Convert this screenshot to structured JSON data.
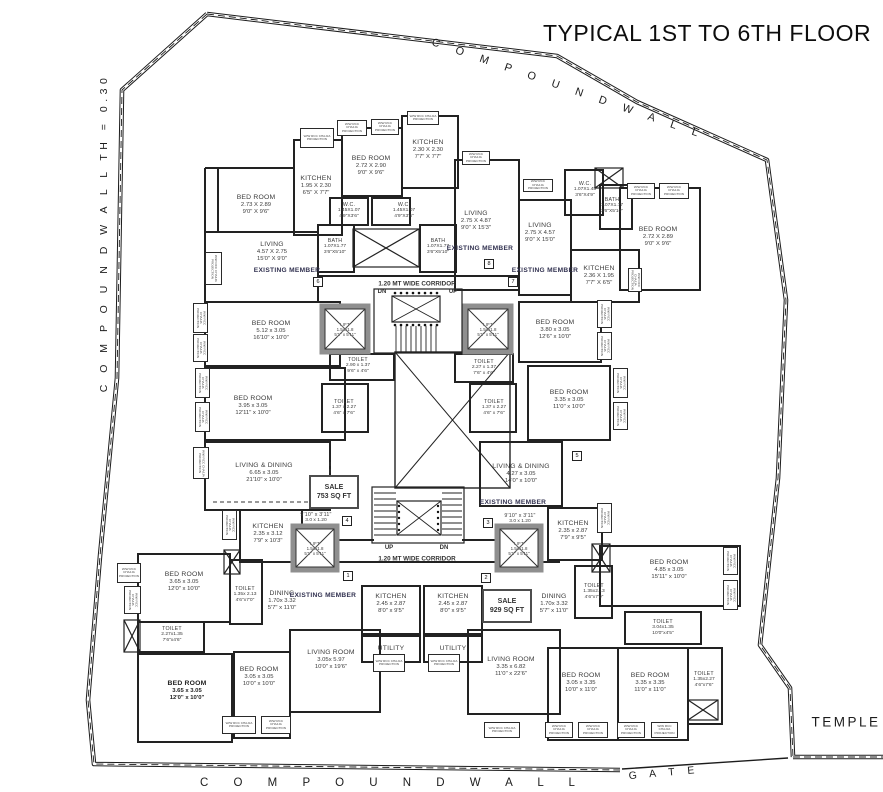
{
  "title": "TYPICAL 1ST TO 6TH FLOOR",
  "boundary": {
    "top_label": "C O M P O U N D   W A L L",
    "left_label": "C O M P O U N D   W A L L   TH = 0.30",
    "bottom_label": "C O M P O U N D   W A L L",
    "gate_label": "G A T E",
    "temple_label": "TEMPLE"
  },
  "corridor": {
    "label": "1.20 MT WIDE CORRIDOR",
    "up": "UP",
    "dn": "DN"
  },
  "colors": {
    "wall": "#222222",
    "lift_border": "#8f8f8f",
    "text": "#3c3c3c",
    "existing_member": "#30304f"
  },
  "chajja": {
    "text": "W/W RCC CHAJJA PROJECTION",
    "boxes": [
      [
        300,
        128,
        34,
        20,
        0
      ],
      [
        337,
        120,
        30,
        16,
        0
      ],
      [
        371,
        119,
        28,
        16,
        0
      ],
      [
        407,
        111,
        32,
        14,
        0
      ],
      [
        462,
        151,
        28,
        14,
        0
      ],
      [
        523,
        179,
        30,
        13,
        0
      ],
      [
        627,
        183,
        28,
        16,
        0
      ],
      [
        659,
        183,
        30,
        16,
        0
      ],
      [
        205,
        252,
        17,
        33,
        1
      ],
      [
        193,
        303,
        15,
        30,
        1
      ],
      [
        193,
        334,
        15,
        28,
        1
      ],
      [
        195,
        368,
        15,
        30,
        1
      ],
      [
        195,
        402,
        15,
        30,
        1
      ],
      [
        193,
        447,
        16,
        32,
        1
      ],
      [
        222,
        510,
        15,
        30,
        1
      ],
      [
        117,
        563,
        24,
        20,
        0
      ],
      [
        124,
        586,
        17,
        28,
        1
      ],
      [
        628,
        268,
        14,
        24,
        1
      ],
      [
        597,
        300,
        15,
        28,
        1
      ],
      [
        597,
        332,
        15,
        28,
        1
      ],
      [
        613,
        368,
        15,
        30,
        1
      ],
      [
        613,
        402,
        15,
        28,
        1
      ],
      [
        597,
        503,
        15,
        30,
        1
      ],
      [
        723,
        547,
        15,
        28,
        1
      ],
      [
        723,
        580,
        15,
        30,
        1
      ],
      [
        222,
        716,
        34,
        18,
        0
      ],
      [
        261,
        716,
        30,
        18,
        0
      ],
      [
        373,
        654,
        32,
        18,
        0
      ],
      [
        428,
        654,
        32,
        18,
        0
      ],
      [
        484,
        722,
        36,
        16,
        0
      ],
      [
        545,
        722,
        28,
        16,
        0
      ],
      [
        578,
        722,
        30,
        16,
        0
      ],
      [
        617,
        722,
        28,
        16,
        0
      ],
      [
        651,
        722,
        27,
        16,
        0
      ]
    ]
  },
  "sale_tags": [
    {
      "line1": "SALE",
      "line2": "753 SQ FT",
      "x": 334,
      "y": 492
    },
    {
      "line1": "SALE",
      "line2": "929 SQ FT",
      "x": 507,
      "y": 606
    }
  ],
  "flat_markers": [
    {
      "t": "1",
      "x": 348,
      "y": 576
    },
    {
      "t": "2",
      "x": 486,
      "y": 578
    },
    {
      "t": "3",
      "x": 488,
      "y": 523
    },
    {
      "t": "4",
      "x": 347,
      "y": 521
    },
    {
      "t": "5",
      "x": 577,
      "y": 456
    },
    {
      "t": "6",
      "x": 318,
      "y": 282
    },
    {
      "t": "7",
      "x": 513,
      "y": 282
    },
    {
      "t": "8",
      "x": 489,
      "y": 264
    }
  ],
  "rooms": [
    {
      "n": "BED ROOM",
      "m": "2.73 X 2.89",
      "f": "9'0\" X 9'6\"",
      "x": 256,
      "y": 205
    },
    {
      "n": "KITCHEN",
      "m": "1.95 X 2.30",
      "f": "6'5\" X 7'7\"",
      "x": 316,
      "y": 186
    },
    {
      "n": "BED ROOM",
      "m": "2.72 X 2.90",
      "f": "9'0\" X 9'6\"",
      "x": 371,
      "y": 166
    },
    {
      "n": "KITCHEN",
      "m": "2.30 X 2.30",
      "f": "7'7\" X 7'7\"",
      "x": 428,
      "y": 150
    },
    {
      "n": "W.C.",
      "m": "1.45X1.07",
      "f": "4'9\"X3'6\"",
      "x": 349,
      "y": 211,
      "cls": "small"
    },
    {
      "n": "W.C.",
      "m": "1.45X1.07",
      "f": "4'9\"X3'6\"",
      "x": 404,
      "y": 211,
      "cls": "small"
    },
    {
      "n": "BATH",
      "m": "1.07X1.77",
      "f": "3'6\"X5'10\"",
      "x": 335,
      "y": 247,
      "cls": "small"
    },
    {
      "n": "BATH",
      "m": "1.07X1.77",
      "f": "3'6\"X5'10\"",
      "x": 438,
      "y": 247,
      "cls": "small"
    },
    {
      "n": "LIVING",
      "m": "4.57 X 2.75",
      "f": "15'0\" X 9'0\"",
      "x": 272,
      "y": 252
    },
    {
      "n": "EXISTING MEMBER",
      "x": 287,
      "y": 271,
      "cls": "em"
    },
    {
      "n": "LIVING",
      "m": "2.75 X 4.87",
      "f": "9'0\" X 15'3\"",
      "x": 476,
      "y": 221
    },
    {
      "n": "EXISTING MEMBER",
      "x": 480,
      "y": 249,
      "cls": "em"
    },
    {
      "n": "LIVING",
      "m": "2.75 X 4.57",
      "f": "9'0\" X 15'0\"",
      "x": 540,
      "y": 233
    },
    {
      "n": "EXISTING MEMBER",
      "x": 545,
      "y": 271,
      "cls": "em"
    },
    {
      "n": "W.C.",
      "m": "1.07X1.45",
      "f": "3'6\"X4'9\"",
      "x": 585,
      "y": 190,
      "cls": "small"
    },
    {
      "n": "BATH",
      "m": "1.07X1.77",
      "f": "3'6\"X5'10\"",
      "x": 612,
      "y": 206,
      "cls": "small"
    },
    {
      "n": "BED ROOM",
      "m": "2.72 X 2.89",
      "f": "9'0\" X 9'6\"",
      "x": 658,
      "y": 237
    },
    {
      "n": "KITCHEN",
      "m": "2.36 X 1.95",
      "f": "7'7\" X 6'5\"",
      "x": 599,
      "y": 276
    },
    {
      "n": "BED ROOM",
      "m": "5.12 x 3.05",
      "f": "16'10\" x 10'0\"",
      "x": 271,
      "y": 331
    },
    {
      "n": "BED ROOM",
      "m": "3.95 x 3.05",
      "f": "12'11\" x 10'0\"",
      "x": 253,
      "y": 406
    },
    {
      "n": "TOILET",
      "m": "2.90 x 1.37",
      "f": "9'6\" x 4'6\"",
      "x": 358,
      "y": 366,
      "cls": "small"
    },
    {
      "n": "TOILET",
      "m": "2.27 x 1.37",
      "f": "7'6\" x 4'6\"",
      "x": 484,
      "y": 368,
      "cls": "small"
    },
    {
      "n": "TOILET",
      "m": "1.37 x 2.27",
      "f": "4'6\" x 7'6\"",
      "x": 344,
      "y": 408,
      "cls": "small"
    },
    {
      "n": "TOILET",
      "m": "1.37 x 2.27",
      "f": "4'6\" x 7'6\"",
      "x": 494,
      "y": 408,
      "cls": "small"
    },
    {
      "n": "BED ROOM",
      "m": "3.80 x 3.05",
      "f": "12'6\" x 10'0\"",
      "x": 555,
      "y": 330
    },
    {
      "n": "BED ROOM",
      "m": "3.35 x 3.05",
      "f": "11'0\" x 10'0\"",
      "x": 569,
      "y": 400
    },
    {
      "n": "LIVING & DINING",
      "m": "6.65 x 3.05",
      "f": "21'10\" x 10'0\"",
      "x": 264,
      "y": 473
    },
    {
      "n": "LIVING & DINING",
      "m": "4.27 x 3.05",
      "f": "14'0\" x 10'0\"",
      "x": 521,
      "y": 474
    },
    {
      "n": "9'10\" x 3'11\"",
      "m": "3.0 x 1.20",
      "x": 316,
      "y": 518,
      "cls": "small"
    },
    {
      "n": "9'10\" x 3'11\"",
      "m": "3.0 x 1.20",
      "x": 520,
      "y": 519,
      "cls": "small"
    },
    {
      "n": "EXISTING MEMBER",
      "x": 513,
      "y": 503,
      "cls": "em"
    },
    {
      "n": "KITCHEN",
      "m": "2.35 x 3.12",
      "f": "7'9\" x 10'3\"",
      "x": 268,
      "y": 534
    },
    {
      "n": "KITCHEN",
      "m": "2.35 x 2.87",
      "f": "7'9\" x 9'5\"",
      "x": 573,
      "y": 531
    },
    {
      "n": "LIFT",
      "m": "1.54x1.8",
      "f": "5'1\" x 5'11\"",
      "x": 345,
      "y": 330,
      "cls": "lift"
    },
    {
      "n": "LIFT",
      "m": "1.54x1.8",
      "f": "5'1\" x 5'11\"",
      "x": 488,
      "y": 330,
      "cls": "lift"
    },
    {
      "n": "LIFT",
      "m": "1.54x1.8",
      "f": "5'1\" x 5'11\"",
      "x": 315,
      "y": 549,
      "cls": "lift"
    },
    {
      "n": "LIFT",
      "m": "1.54x1.8",
      "f": "5'1\" x 5'11\"",
      "x": 519,
      "y": 549,
      "cls": "lift"
    },
    {
      "n": "KITCHEN",
      "m": "2.45 x 2.87",
      "f": "8'0\" x 9'5\"",
      "x": 391,
      "y": 604
    },
    {
      "n": "KITCHEN",
      "m": "2.45 x 2.87",
      "f": "8'0\" x 9'5\"",
      "x": 453,
      "y": 604
    },
    {
      "n": "UTILITY",
      "x": 391,
      "y": 649
    },
    {
      "n": "UTILITY",
      "x": 453,
      "y": 649
    },
    {
      "n": "DINING",
      "m": "1.70x 3.32",
      "f": "5'7\" x 11'0\"",
      "x": 554,
      "y": 604
    },
    {
      "n": "DINING",
      "m": "1.70x 3.32",
      "f": "5'7\" x 11'0\"",
      "x": 282,
      "y": 601
    },
    {
      "n": "EXISTING MEMBER",
      "x": 323,
      "y": 596,
      "cls": "em"
    },
    {
      "n": "BED ROOM",
      "m": "3.65 x 3.05",
      "f": "12'0\" x 10'0\"",
      "x": 184,
      "y": 582
    },
    {
      "n": "TOILET",
      "m": "1.35x 2.13",
      "f": "4'6\"x7'0\"",
      "x": 245,
      "y": 595,
      "cls": "small"
    },
    {
      "n": "TOILET",
      "m": "2.27x1.35",
      "f": "7'6\"x4'6\"",
      "x": 172,
      "y": 635,
      "cls": "small"
    },
    {
      "n": "BED ROOM",
      "m": "3.65 x 3.05",
      "f": "12'0\" x 10'0\"",
      "x": 187,
      "y": 691,
      "cls": "bold"
    },
    {
      "n": "BED ROOM",
      "m": "3.05 x 3.05",
      "f": "10'0\" x 10'0\"",
      "x": 259,
      "y": 677
    },
    {
      "n": "LIVING ROOM",
      "m": "3.05x 5.97",
      "f": "10'0\" x 19'6\"",
      "x": 331,
      "y": 660
    },
    {
      "n": "LIVING ROOM",
      "m": "3.35 x 6.82",
      "f": "11'0\" x 22'6\"",
      "x": 511,
      "y": 667
    },
    {
      "n": "BED ROOM",
      "m": "4.85 x 3.05",
      "f": "15'11\" x 10'0\"",
      "x": 669,
      "y": 570
    },
    {
      "n": "TOILET",
      "m": "1.35x2.13",
      "f": "4'6\"x7'0\"",
      "x": 594,
      "y": 592,
      "cls": "small"
    },
    {
      "n": "TOILET",
      "m": "3.04x1.35",
      "f": "10'0\"x4'5\"",
      "x": 663,
      "y": 628,
      "cls": "small"
    },
    {
      "n": "BED ROOM",
      "m": "3.05 x 3.35",
      "f": "10'0\" x 11'0\"",
      "x": 581,
      "y": 683
    },
    {
      "n": "BED ROOM",
      "m": "3.35 x 3.35",
      "f": "11'0\" x 11'0\"",
      "x": 650,
      "y": 683
    },
    {
      "n": "TOILET",
      "m": "1.35x2.27",
      "f": "4'6\"x7'6\"",
      "x": 704,
      "y": 680,
      "cls": "small"
    }
  ]
}
